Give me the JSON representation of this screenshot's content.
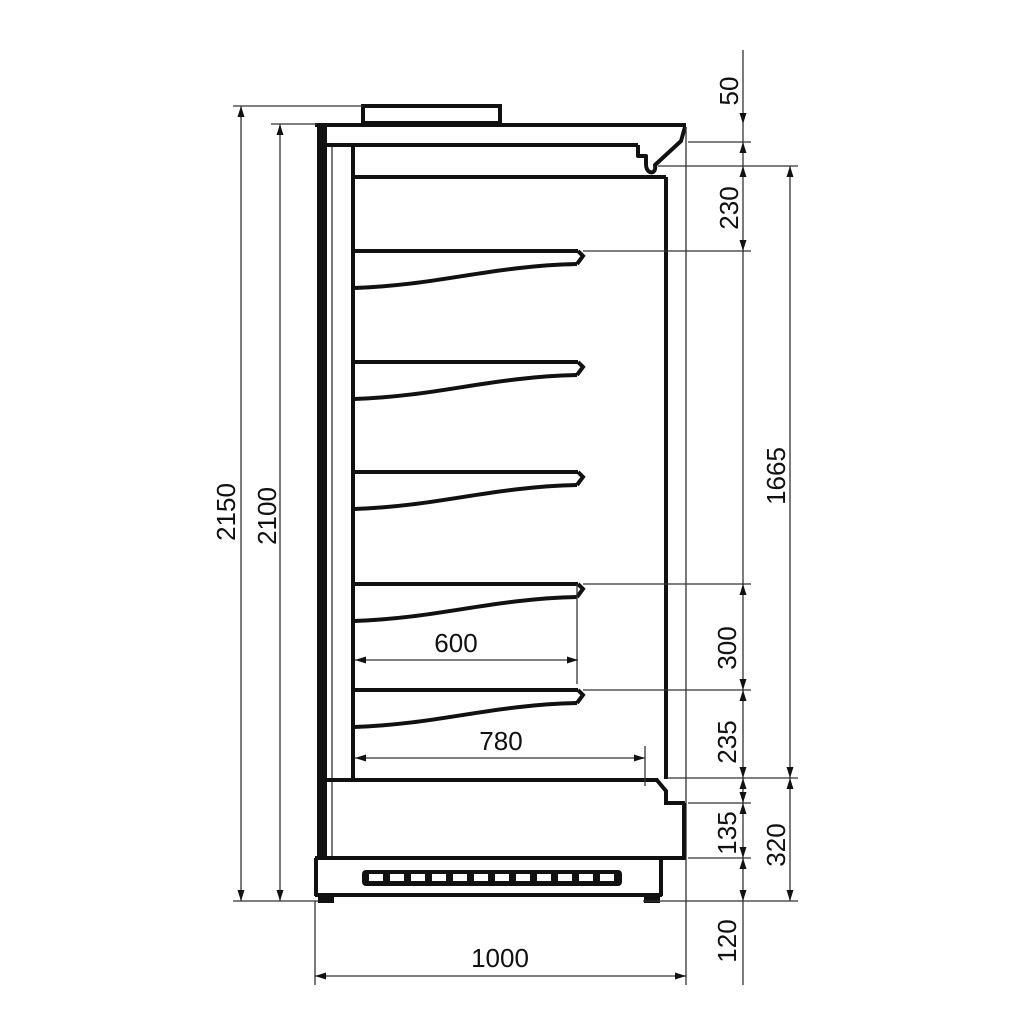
{
  "drawing": {
    "kind": "refrigerated-multideck-cabinet-side-section",
    "line_color": "#111111",
    "background": "#ffffff",
    "dimensions": {
      "left_outer": "2150",
      "left_inner": "2100",
      "right_chain": {
        "top_cap": "50",
        "canopy_to_first_shelf": "230",
        "shelf_gap": "300",
        "bottom_shelf_to_floor": "235",
        "front_panel": "135",
        "plinth": "120"
      },
      "right_outer": {
        "opening_height": "1665",
        "base_height": "320"
      },
      "depth": {
        "upper_shelf": "600",
        "lower_shelf": "780",
        "overall": "1000"
      }
    }
  }
}
